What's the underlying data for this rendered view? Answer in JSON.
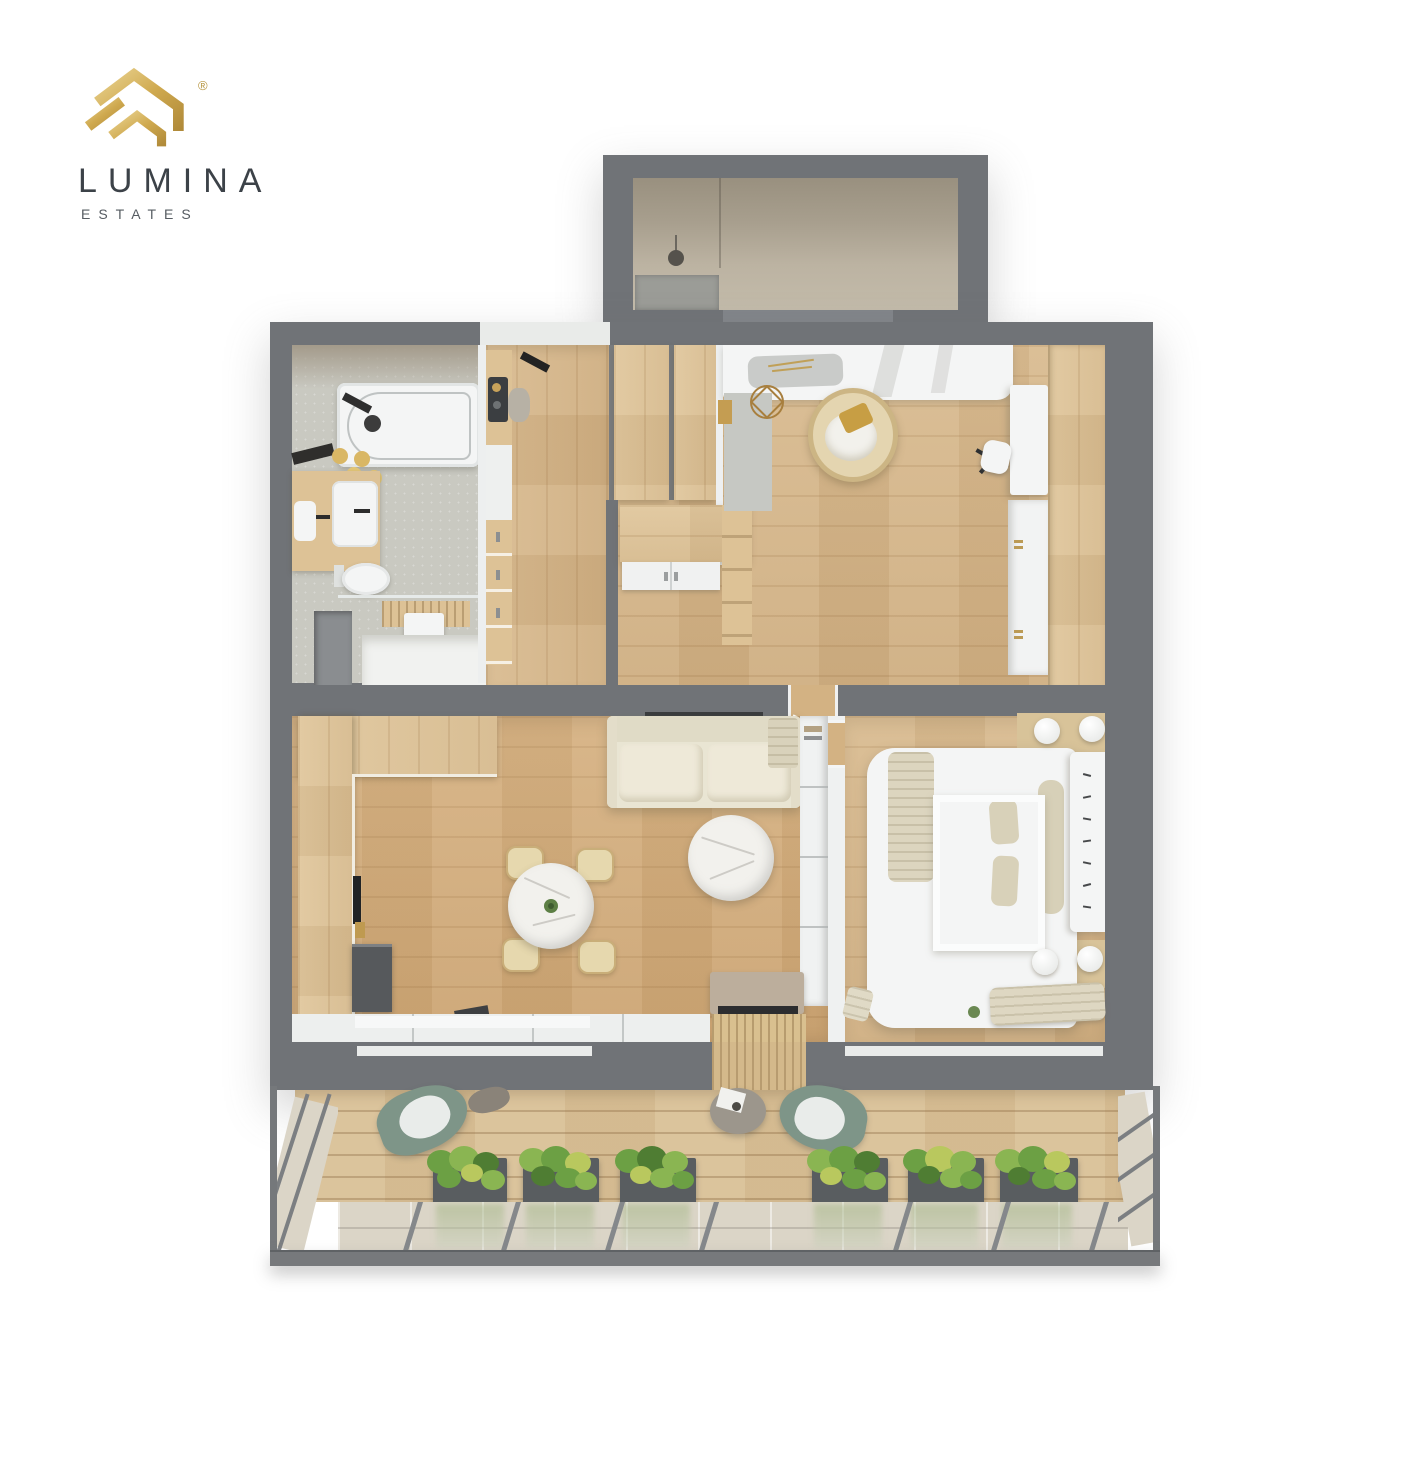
{
  "logo": {
    "brand": "LUMINA",
    "sub": "ESTATES",
    "registered": "®",
    "icon": "house-roof-icon"
  },
  "colors": {
    "gold": "#c8a254",
    "gold_light": "#ecd492",
    "gold_dark": "#ad8534",
    "brand_text": "#3c4248",
    "wall": "#707377",
    "wood_floor": "#d5b588",
    "wood_furniture": "#ddc296",
    "deck": "#d9c096",
    "bath_tile": "#c9c9c1",
    "vestibule_floor": "#b7ae9c",
    "white_fixture": "#f4f5f5",
    "sofa_cream": "#e9e5d3",
    "rattan": "#e6d8ae",
    "balcony_chair_green": "#7e9588",
    "plant_green": "#6ca044",
    "marble": "#f2f1ed",
    "rug_gray": "#c6c8c3",
    "cabinet_dark": "#56595c",
    "nightstand_beige": "#d8c399",
    "blanket_beige": "#dcd5bf",
    "planter_box": "#595d60",
    "glass_rail": "#dbd5c7"
  }
}
